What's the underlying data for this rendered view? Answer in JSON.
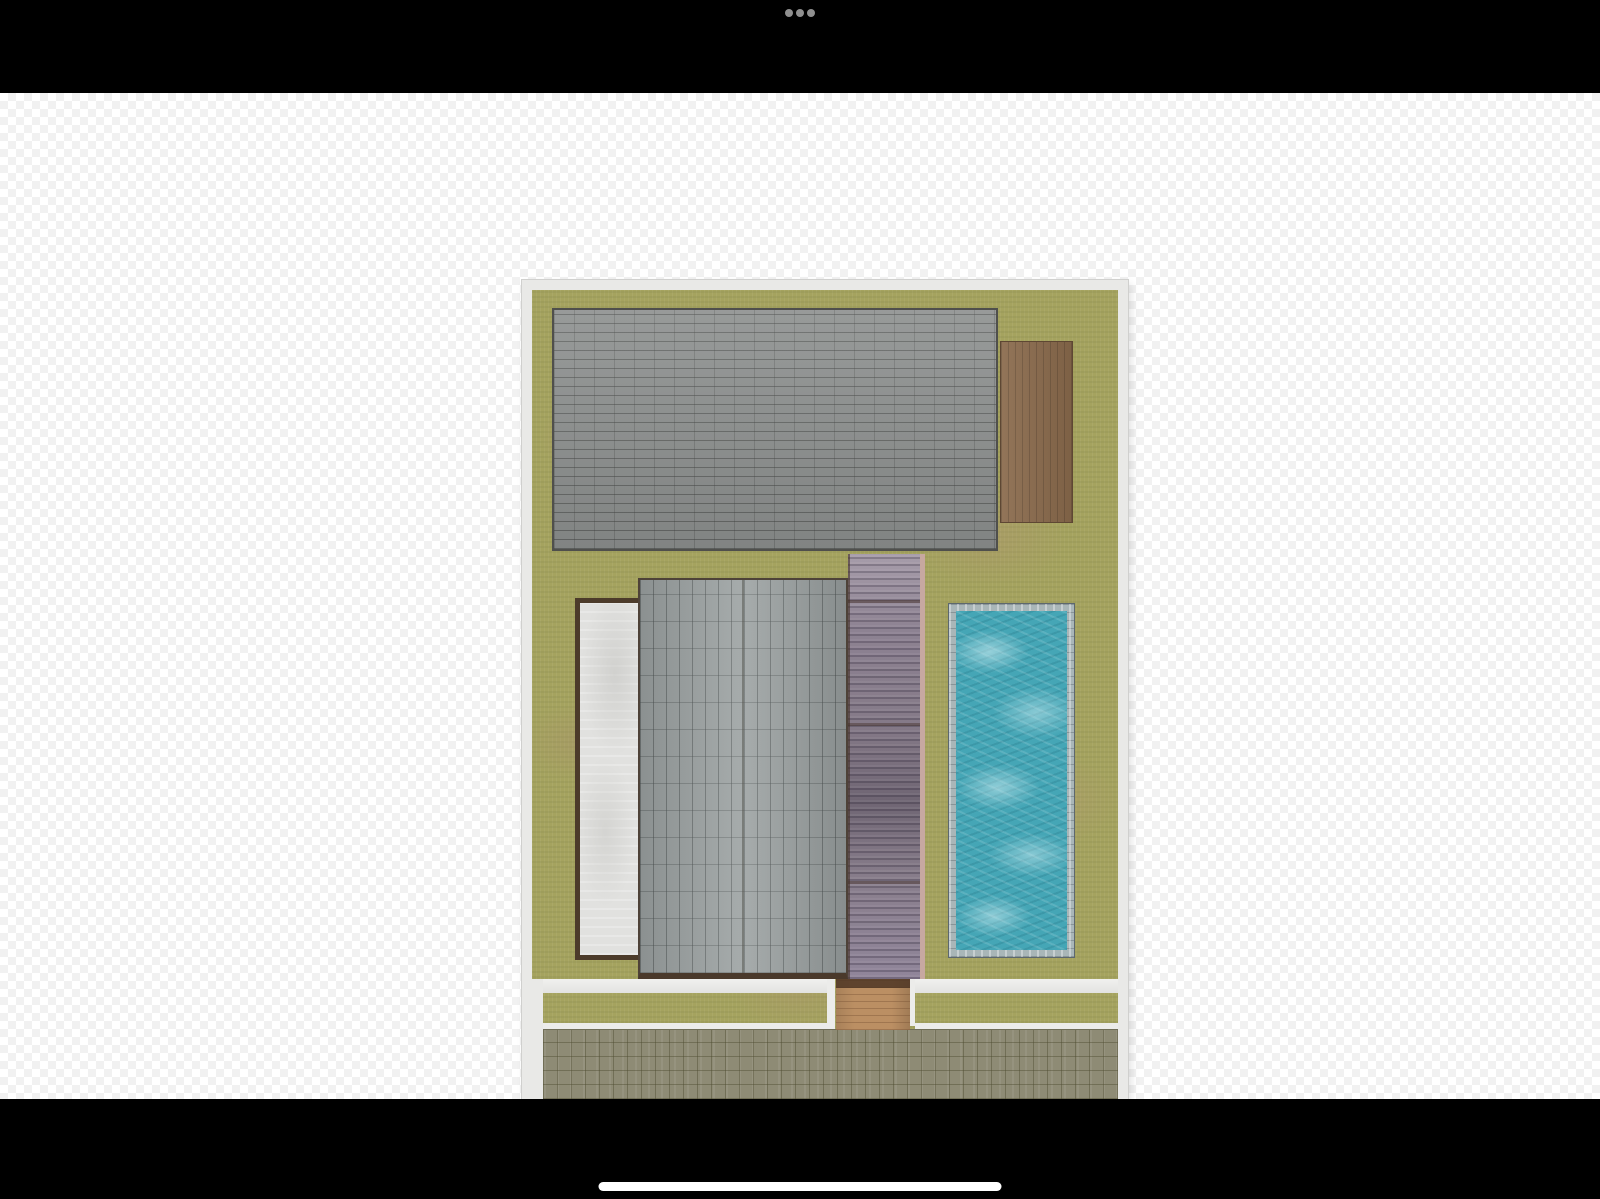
{
  "screen": {
    "width": 1600,
    "height": 1199
  },
  "top_bar": {
    "background": "#000000",
    "menu_icon": "ellipsis-horizontal-icon",
    "dot_color": "#8f8f8f",
    "dot_count": 3
  },
  "canvas": {
    "background_pattern": "transparency-checkerboard",
    "checker_colors": [
      "#ffffff",
      "#f1f1f1"
    ],
    "checker_size_px": 16
  },
  "floor_plan": {
    "view": "2d-top-down-site-plan",
    "frame_color": "#e9e9e7",
    "elements": [
      {
        "name": "lawn",
        "type": "grass",
        "color": "#a5a35f"
      },
      {
        "name": "main-roof",
        "type": "roof",
        "texture": "gray-brick-shingles-horizontal",
        "color": "#8c8f8e"
      },
      {
        "name": "wood-deck",
        "type": "deck",
        "texture": "wood-planks-vertical",
        "color": "#8a6a4c"
      },
      {
        "name": "concrete-pad",
        "type": "patio",
        "color": "#e1e1df",
        "border_color": "#4c3b2a"
      },
      {
        "name": "secondary-roof",
        "type": "roof",
        "texture": "gray-brick-shingles-vertical",
        "color": "#9ba1a1"
      },
      {
        "name": "pergola-canopy",
        "type": "canopy",
        "texture": "slatted-translucent",
        "color": "#857a88",
        "trim_color": "#c7a8a0"
      },
      {
        "name": "swimming-pool",
        "type": "pool",
        "water_color": "#45a6b6",
        "coping_color": "#a9b6b8"
      },
      {
        "name": "garden-walkway",
        "type": "path",
        "color": "#eaeae8"
      },
      {
        "name": "entry-step",
        "type": "wood-step",
        "color": "#bb8f63"
      },
      {
        "name": "driveway",
        "type": "paving",
        "texture": "square-pavers",
        "color": "#8e8b75"
      }
    ]
  },
  "bottom_bar": {
    "background": "#000000",
    "home_indicator_color": "#ffffff"
  }
}
